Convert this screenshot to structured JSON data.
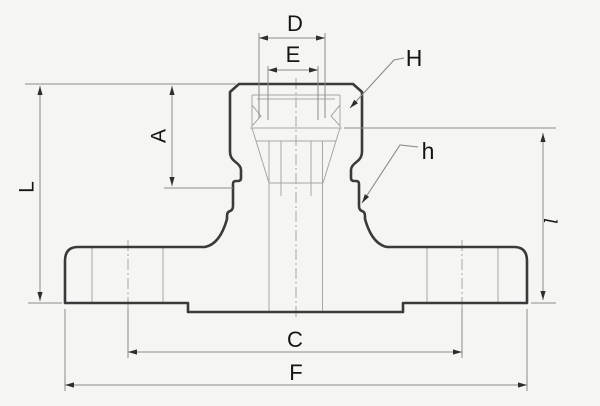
{
  "diagram": {
    "type": "technical-drawing",
    "subject": "flanged compression fitting cross-section with dimension callouts",
    "dimension_labels": {
      "D": "D",
      "E": "E",
      "H": "H",
      "A": "A",
      "h": "h",
      "L": "L",
      "l": "l",
      "C": "C",
      "F": "F"
    },
    "colors": {
      "background": "#f5f5f3",
      "outline": "#3a3a3a",
      "dimension-line": "#8a8a8a",
      "detail-line": "#a6a6a6",
      "label": "#141414"
    }
  }
}
